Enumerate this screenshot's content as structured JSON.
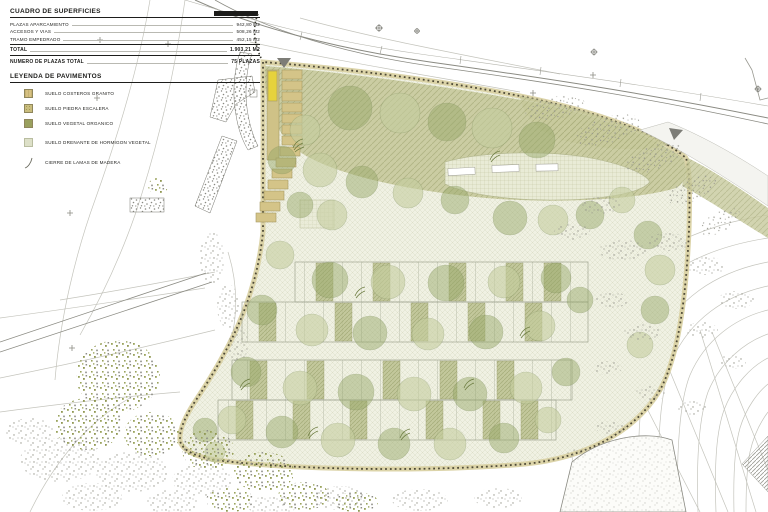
{
  "panel": {
    "surfaces_title": "CUADRO DE SUPERFICIES",
    "rows": [
      {
        "label": "PLAZAS APARCAMIENTO",
        "value": "942,80 M2"
      },
      {
        "label": "ACCESOS Y VIAS",
        "value": "508,26 M2"
      },
      {
        "label": "TRAMO EMPEDRADO",
        "value": "452,15 M2"
      }
    ],
    "total_label": "TOTAL",
    "total_value": "1.903,21 M2",
    "plazas_label": "NUMERO DE PLAZAS TOTAL",
    "plazas_value": "75 PLAZAS",
    "legend_title": "LEYENDA DE PAVIMENTOS",
    "legend": [
      {
        "label": "SUELO COSTEROS GRANITO",
        "color": "#d6c183"
      },
      {
        "label": "SUELO PIEDRA ESCALERA",
        "color": "#c9bd7d"
      },
      {
        "label": "SUELO VEGETAL ORGANICO",
        "color": "#9aa05e"
      },
      {
        "label": "SUELO DRENANTE DE HORMIGON VEGETAL",
        "color": "#dde0c8"
      },
      {
        "label": "CIERRE DE LAMAS DE MADERA",
        "symbol": "wood-slat-fence-curve"
      }
    ]
  },
  "palette": {
    "tree_sage": "#96a869",
    "tree_pale": "#c5cd9e",
    "olive_band": "#c7c99c",
    "lot_hatch": "#f0f1e3",
    "boundary_dots": "#4d4936",
    "boundary_band": "#d8cfa0",
    "highlight_yellow": "#e6d23c",
    "contour_grey": "#c2c2ba"
  }
}
